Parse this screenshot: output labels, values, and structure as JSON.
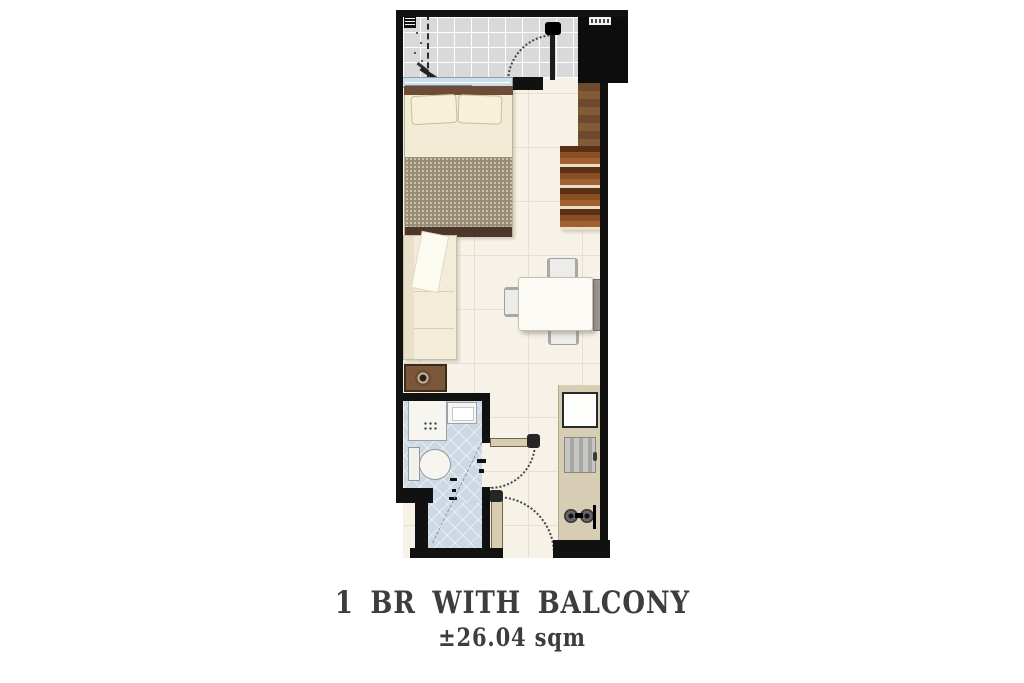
{
  "caption": {
    "unit_type": "1 BR WITH BALCONY",
    "area": "±26.04 sqm"
  },
  "plan": {
    "kind": "condominium floor plan",
    "rooms": [
      "balcony",
      "bedroom",
      "living-dining",
      "kitchen",
      "bathroom"
    ],
    "corridor_label": {
      "legible": false,
      "style": "small white chip with dark smudged text"
    },
    "fixtures": [
      "bed",
      "wardrobe",
      "sofa",
      "side-table",
      "dining-table",
      "dining-chairs",
      "refrigerator",
      "kitchen-sink",
      "two-burner-stove",
      "shower",
      "lavatory",
      "toilet",
      "sliding-glass-door",
      "balcony-swing-door",
      "bathroom-door",
      "entrance-door"
    ]
  },
  "palette": {
    "wall": "#111111",
    "floor_main": "#f6f2e7",
    "floor_balcony": "#d9d9d9",
    "floor_bath": "#ccd8e3",
    "wood_dark": "#5a3a24",
    "wood_mid": "#8a5530",
    "fabric_cream": "#f2ebd5",
    "blanket_taupe": "#978c78",
    "counter_tan": "#d6cdb4",
    "text": "#3d3d3d"
  }
}
